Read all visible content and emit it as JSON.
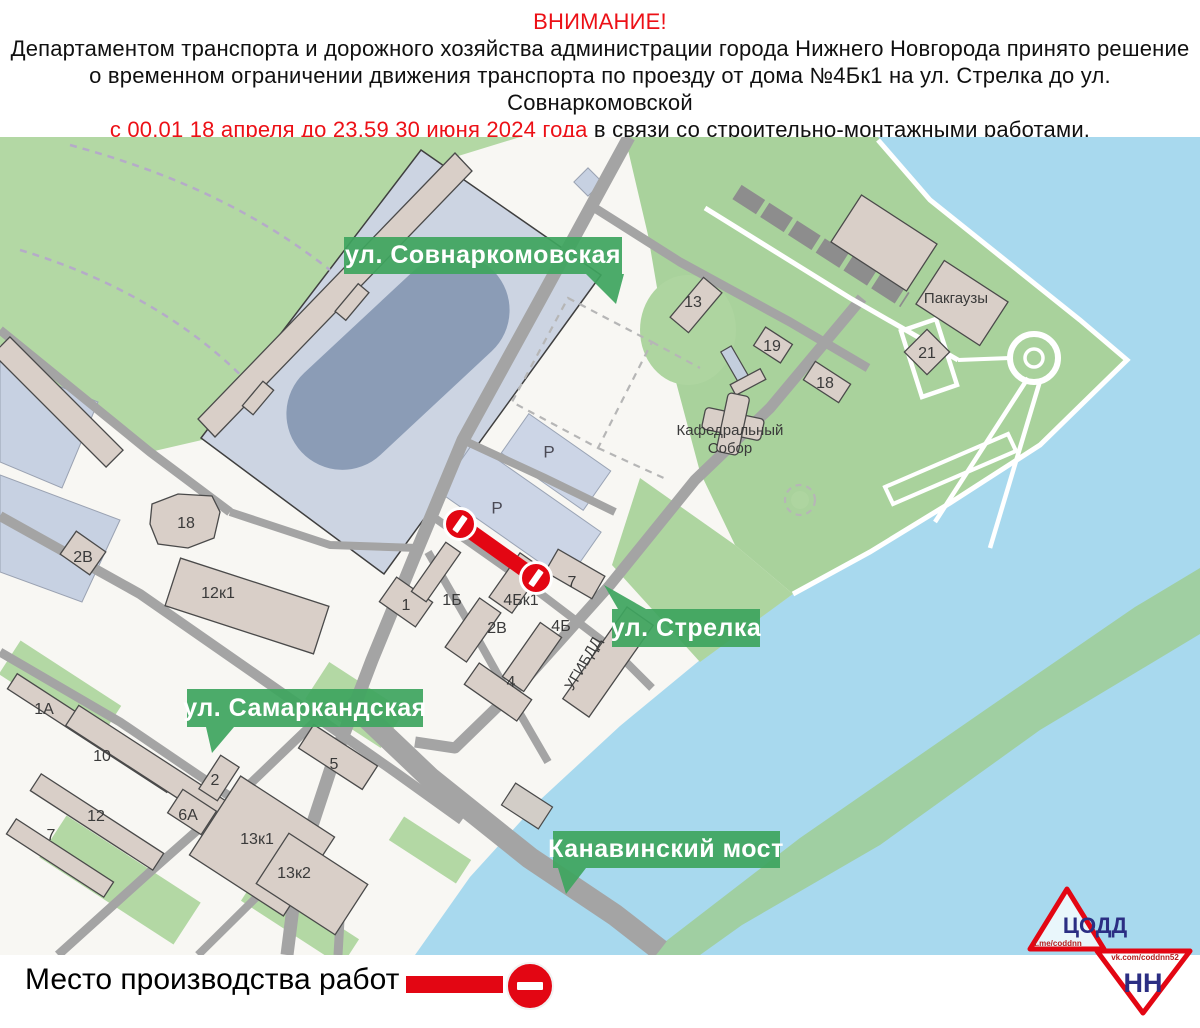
{
  "header": {
    "title": "ВНИМАНИЕ!",
    "line2": "Департаментом транспорта и дорожного хозяйства администрации города Нижнего Новгорода принято решение",
    "line3": "о временном ограничении движения транспорта по проезду от дома №4Бк1 на ул. Стрелка до ул. Совнаркомовской",
    "line4_red": "с 00.01 18 апреля до 23.59 30 июня 2024 года",
    "line4_black": " в связи со строительно-монтажными работами.",
    "line5": "Просим автомобилистов быть предельно внимательными и следовать указаниям дорожных знаков."
  },
  "map": {
    "street_labels": [
      {
        "text": "ул. Совнаркомовская"
      },
      {
        "text": "ул. Стрелка"
      },
      {
        "text": "ул. Самаркандская"
      },
      {
        "text": "Канавинский мост"
      }
    ],
    "poi_labels": {
      "pakgauzy": "Пакгаузы",
      "cathedral_line1": "Кафедральный",
      "cathedral_line2": "Собор",
      "ugibdd": "УГИБДД",
      "parking": "Р"
    },
    "building_labels": [
      {
        "text": "13"
      },
      {
        "text": "19"
      },
      {
        "text": "18"
      },
      {
        "text": "21"
      },
      {
        "text": "18"
      },
      {
        "text": "2В"
      },
      {
        "text": "12к1"
      },
      {
        "text": "1"
      },
      {
        "text": "1Б"
      },
      {
        "text": "4Бк1"
      },
      {
        "text": "2В"
      },
      {
        "text": "4Б"
      },
      {
        "text": "7"
      },
      {
        "text": "4"
      },
      {
        "text": "1А"
      },
      {
        "text": "10"
      },
      {
        "text": "2"
      },
      {
        "text": "12"
      },
      {
        "text": "6А"
      },
      {
        "text": "7"
      },
      {
        "text": "5"
      },
      {
        "text": "13к1"
      },
      {
        "text": "13к2"
      }
    ]
  },
  "legend": {
    "text": "Место производства работ -"
  },
  "logo": {
    "line1": "ЦОДД",
    "line2": "НН",
    "telegram": "t.me/coddnn",
    "vk": "vk.com/coddnn52"
  },
  "colors": {
    "header_red": "#ec1016",
    "banner_green": "#3ea55f",
    "closure_red": "#e30613",
    "water_blue": "#a8d9ee",
    "park_green": "#b3d8a4",
    "stadium_gray_blue": "#ccd4e2",
    "logo_red": "#e30613",
    "logo_blue": "#2b2e83"
  }
}
